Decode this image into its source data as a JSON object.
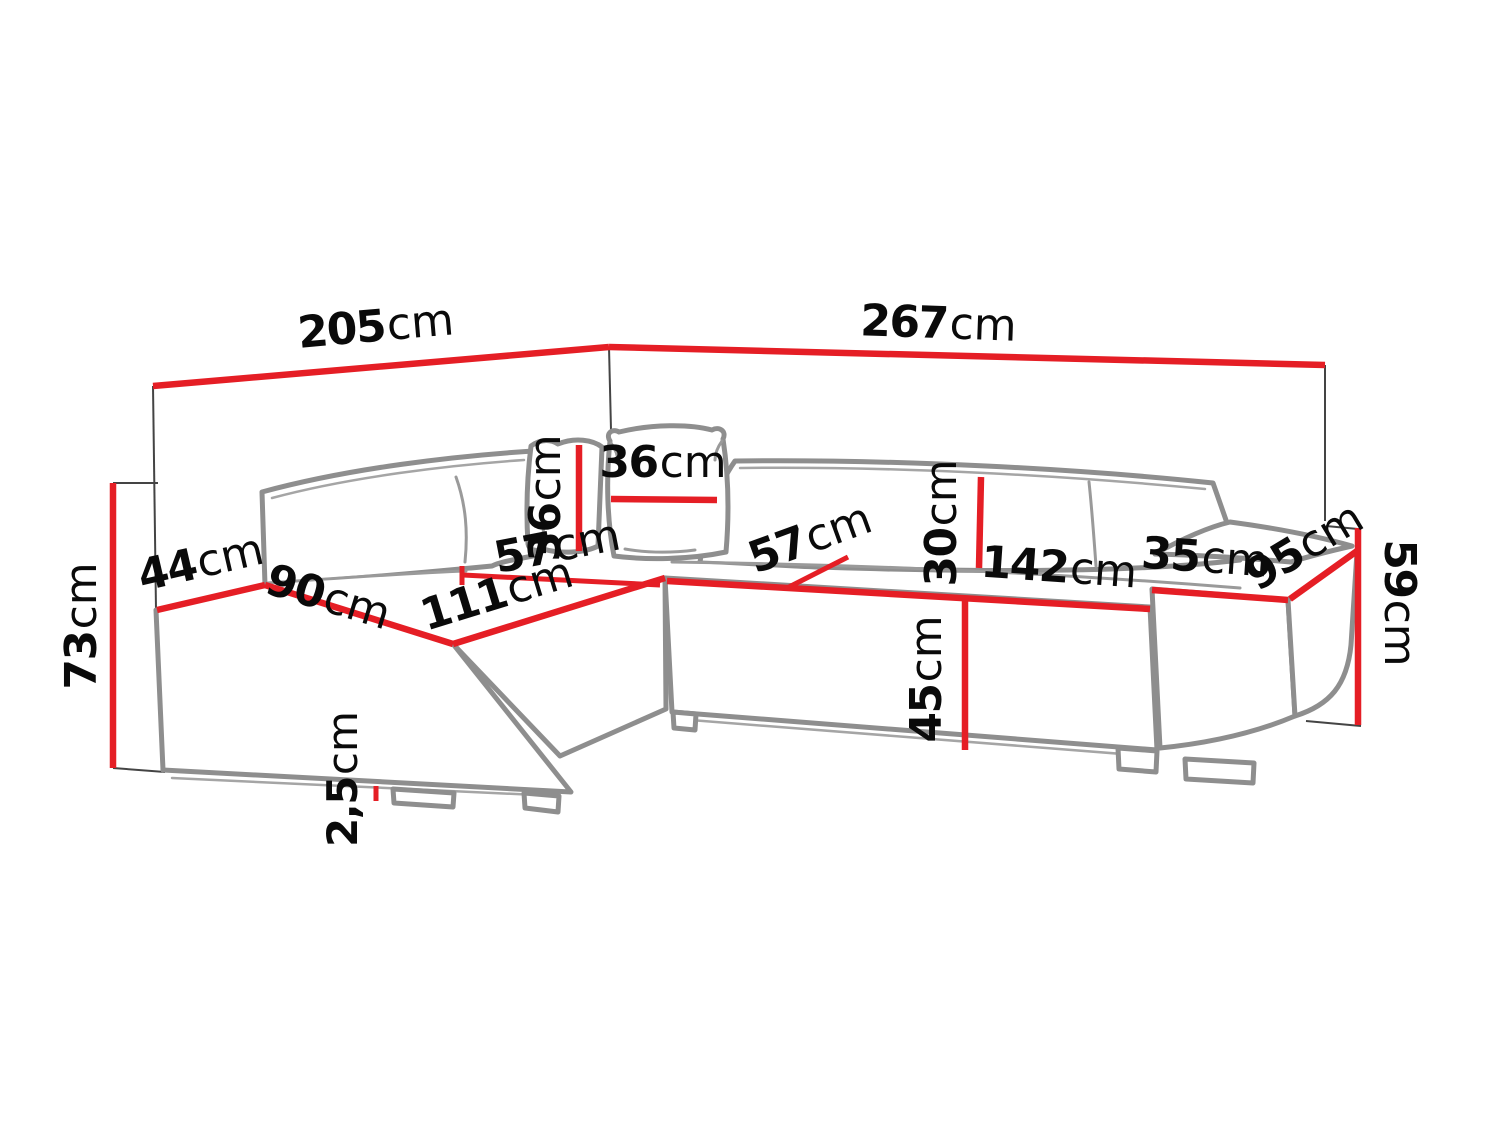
{
  "diagram": {
    "type": "furniture-dimension-diagram",
    "subject": "corner-sofa-dimensions",
    "unit": "cm",
    "colors": {
      "dimension_line": "#e51e25",
      "sofa_outline": "#8e8e8e",
      "label_text": "#0a0a0a",
      "background": "#ffffff"
    },
    "labels": {
      "d205": {
        "value": "205",
        "unit": "cm"
      },
      "d267": {
        "value": "267",
        "unit": "cm"
      },
      "d73": {
        "value": "73",
        "unit": "cm"
      },
      "d44": {
        "value": "44",
        "unit": "cm"
      },
      "d90": {
        "value": "90",
        "unit": "cm"
      },
      "d111": {
        "value": "111",
        "unit": "cm"
      },
      "d57_left": {
        "value": "57",
        "unit": "cm"
      },
      "d57_right": {
        "value": "57",
        "unit": "cm"
      },
      "d36_vertical": {
        "value": "36",
        "unit": "cm"
      },
      "d36_horizontal": {
        "value": "36",
        "unit": "cm"
      },
      "d30": {
        "value": "30",
        "unit": "cm"
      },
      "d142": {
        "value": "142",
        "unit": "cm"
      },
      "d35": {
        "value": "35",
        "unit": "cm"
      },
      "d95": {
        "value": "95",
        "unit": "cm"
      },
      "d59": {
        "value": "59",
        "unit": "cm"
      },
      "d45": {
        "value": "45",
        "unit": "cm"
      },
      "d2_5": {
        "value": "2,5",
        "unit": "cm"
      }
    }
  }
}
